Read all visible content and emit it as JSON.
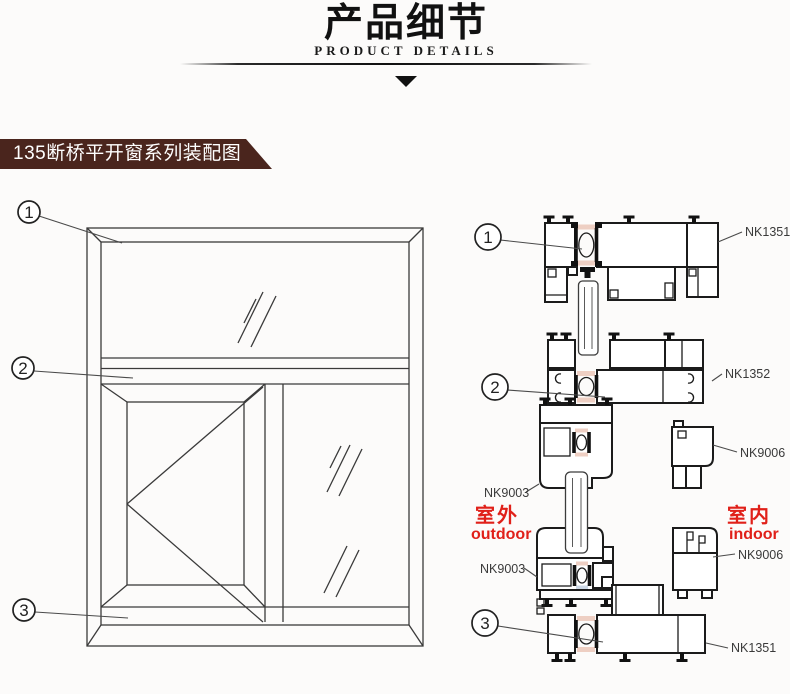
{
  "header": {
    "title": "产品细节",
    "subtitle": "PRODUCT DETAILS"
  },
  "banner": {
    "text": "135断桥平开窗系列装配图"
  },
  "window": {
    "callouts": [
      "1",
      "2",
      "3"
    ]
  },
  "profiles": {
    "callouts": [
      "1",
      "2",
      "3"
    ],
    "labels": {
      "top_frame": "NK1351",
      "transom": "NK1352",
      "mid_bead": "NK9006",
      "mid_sash": "NK9003",
      "bottom_sash": "NK9003",
      "bottom_bead": "NK9006",
      "sill_frame": "NK1351"
    },
    "environment": {
      "outdoor_cn": "室外",
      "outdoor_en": "outdoor",
      "indoor_cn": "室内",
      "indoor_en": "indoor"
    }
  },
  "colors": {
    "banner_bg": "#4a251d",
    "label_red": "#e02019",
    "thermal_pink": "#eecfc3",
    "thermal_blue": "#ccd7e5",
    "line": "#1b1b1b"
  }
}
